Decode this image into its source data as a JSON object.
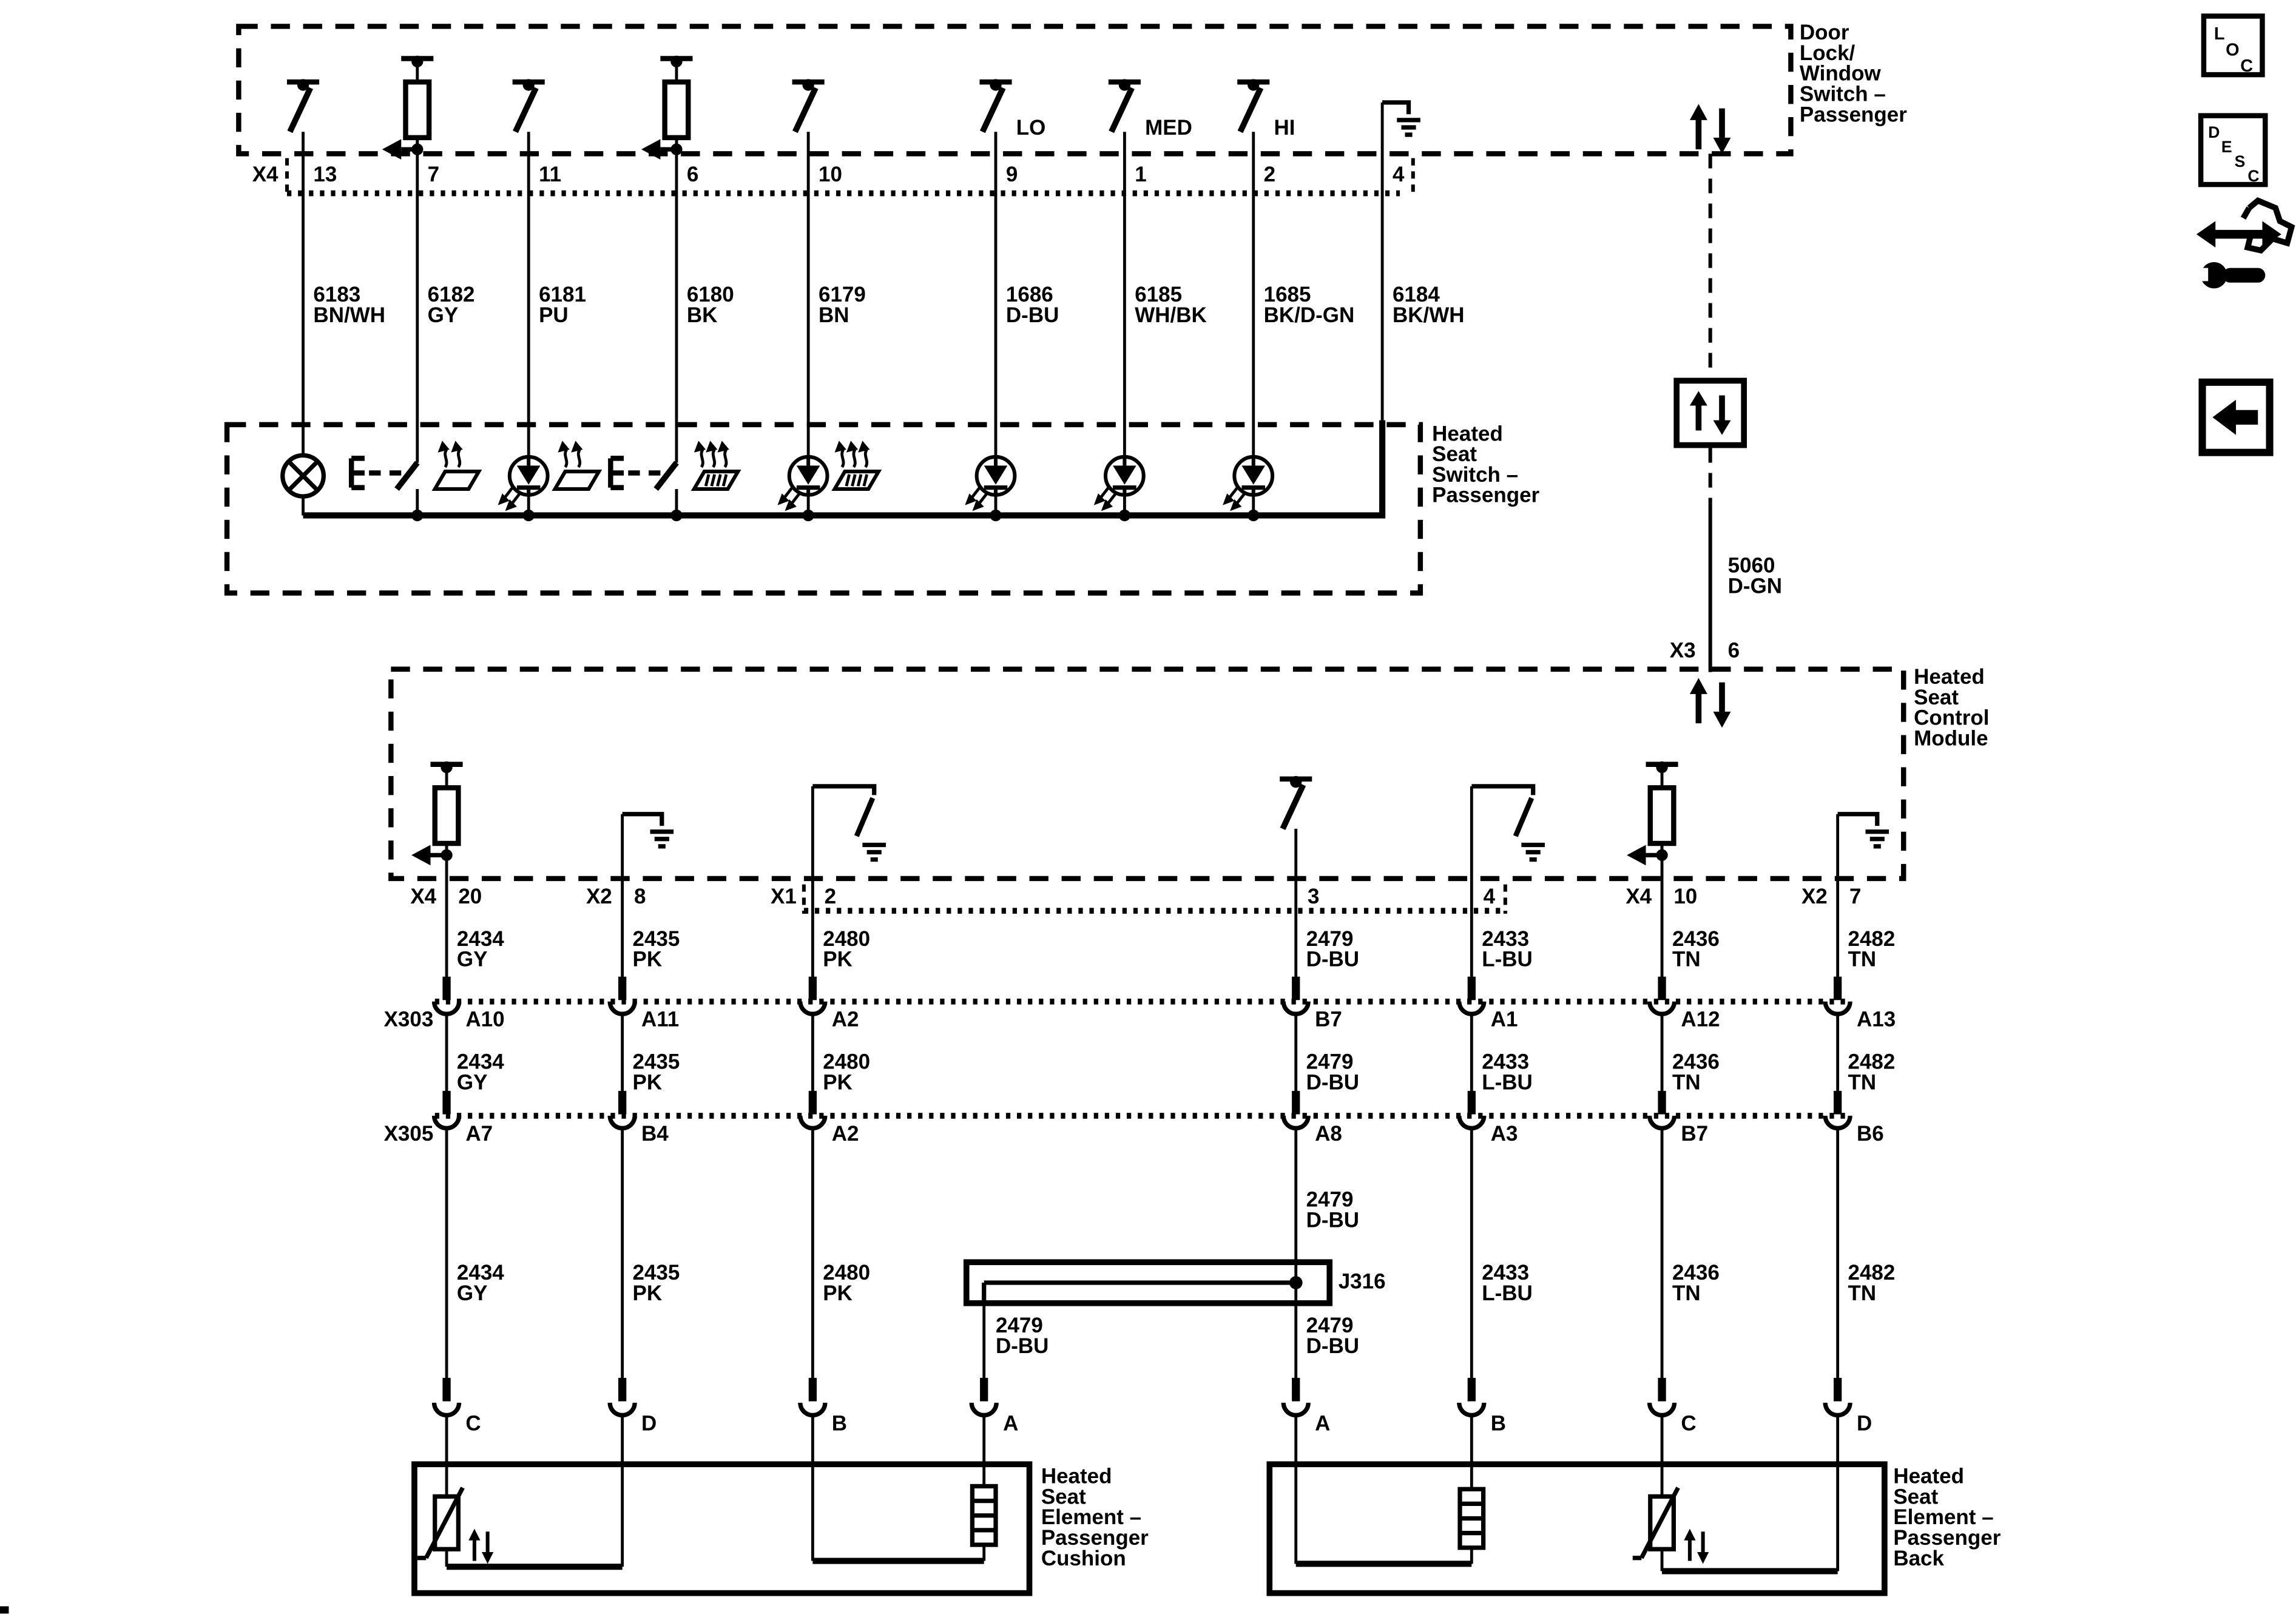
{
  "top_box": {
    "label": [
      "Door",
      "Lock/",
      "Window",
      "Switch –",
      "Passenger"
    ],
    "connector": "X4",
    "pins": [
      "13",
      "7",
      "11",
      "6",
      "10",
      "9",
      "1",
      "2",
      "4"
    ],
    "switch_positions": [
      "LO",
      "MED",
      "HI"
    ]
  },
  "top_wires": [
    [
      "6183",
      "BN/WH"
    ],
    [
      "6182",
      "GY"
    ],
    [
      "6181",
      "PU"
    ],
    [
      "6180",
      "BK"
    ],
    [
      "6179",
      "BN"
    ],
    [
      "1686",
      "D-BU"
    ],
    [
      "6185",
      "WH/BK"
    ],
    [
      "1685",
      "BK/D-GN"
    ],
    [
      "6184",
      "BK/WH"
    ]
  ],
  "switch_box": {
    "label": [
      "Heated",
      "Seat",
      "Switch –",
      "Passenger"
    ]
  },
  "serial_data": {
    "circuit": "5060",
    "color": "D-GN",
    "connector": "X3",
    "pin": "6"
  },
  "module": {
    "label": [
      "Heated",
      "Seat",
      "Control",
      "Module"
    ],
    "pins": [
      [
        "X4",
        "20"
      ],
      [
        "X2",
        "8"
      ],
      [
        "X1",
        "2"
      ],
      [
        "",
        "3"
      ],
      [
        "",
        "4"
      ],
      [
        "X4",
        "10"
      ],
      [
        "X2",
        "7"
      ]
    ]
  },
  "mid_wires": [
    [
      "2434",
      "GY"
    ],
    [
      "2435",
      "PK"
    ],
    [
      "2480",
      "PK"
    ],
    [
      "2479",
      "D-BU"
    ],
    [
      "2433",
      "L-BU"
    ],
    [
      "2436",
      "TN"
    ],
    [
      "2482",
      "TN"
    ]
  ],
  "x303": {
    "name": "X303",
    "pins": [
      "A10",
      "A11",
      "A2",
      "B7",
      "A1",
      "A12",
      "A13"
    ]
  },
  "x305": {
    "name": "X305",
    "pins": [
      "A7",
      "B4",
      "A2",
      "A8",
      "A3",
      "B7",
      "B6"
    ]
  },
  "splice": {
    "name": "J316",
    "circuit": "2479",
    "color": "D-BU"
  },
  "cushion": {
    "label": [
      "Heated",
      "Seat",
      "Element –",
      "Passenger",
      "Cushion"
    ],
    "pins": [
      "C",
      "D",
      "B",
      "A"
    ]
  },
  "back": {
    "label": [
      "Heated",
      "Seat",
      "Element –",
      "Passenger",
      "Back"
    ],
    "pins": [
      "A",
      "B",
      "C",
      "D"
    ]
  },
  "nav_icons": {
    "loc": [
      "L",
      "O",
      "C"
    ],
    "desc": [
      "D",
      "E",
      "S",
      "C"
    ]
  }
}
